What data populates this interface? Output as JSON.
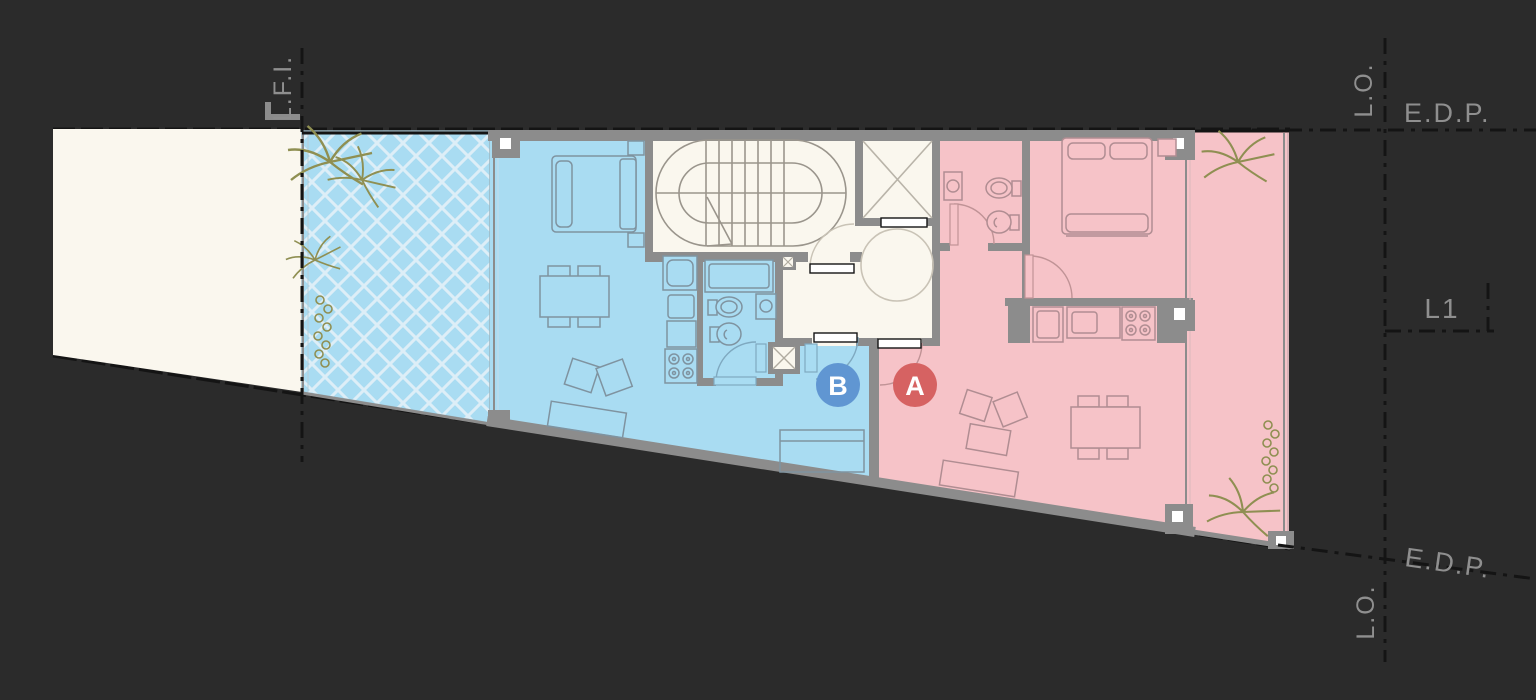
{
  "units": [
    {
      "id": "unit-a",
      "label": "A",
      "badge_color": "#d66262",
      "fill": "#f6c3c8"
    },
    {
      "id": "unit-b",
      "label": "B",
      "badge_color": "#6096d2",
      "fill": "#a9dcf2"
    }
  ],
  "annotations": {
    "lfi_label": "L.F.I.",
    "lo_top_label": "L.O.",
    "edp_top_label": "E.D.P.",
    "level_label": "L1",
    "edp_bottom_label": "E.D.P.",
    "lo_bottom_label": "L.O."
  },
  "colors": {
    "background": "#2b2b2b",
    "wall": "#8c8c8c",
    "common_area": "#faf7ee",
    "yard": "#faf7ee",
    "annotation_text": "#8f8f8f",
    "boundary_line": "#141414",
    "plant": "#8f8f52"
  }
}
